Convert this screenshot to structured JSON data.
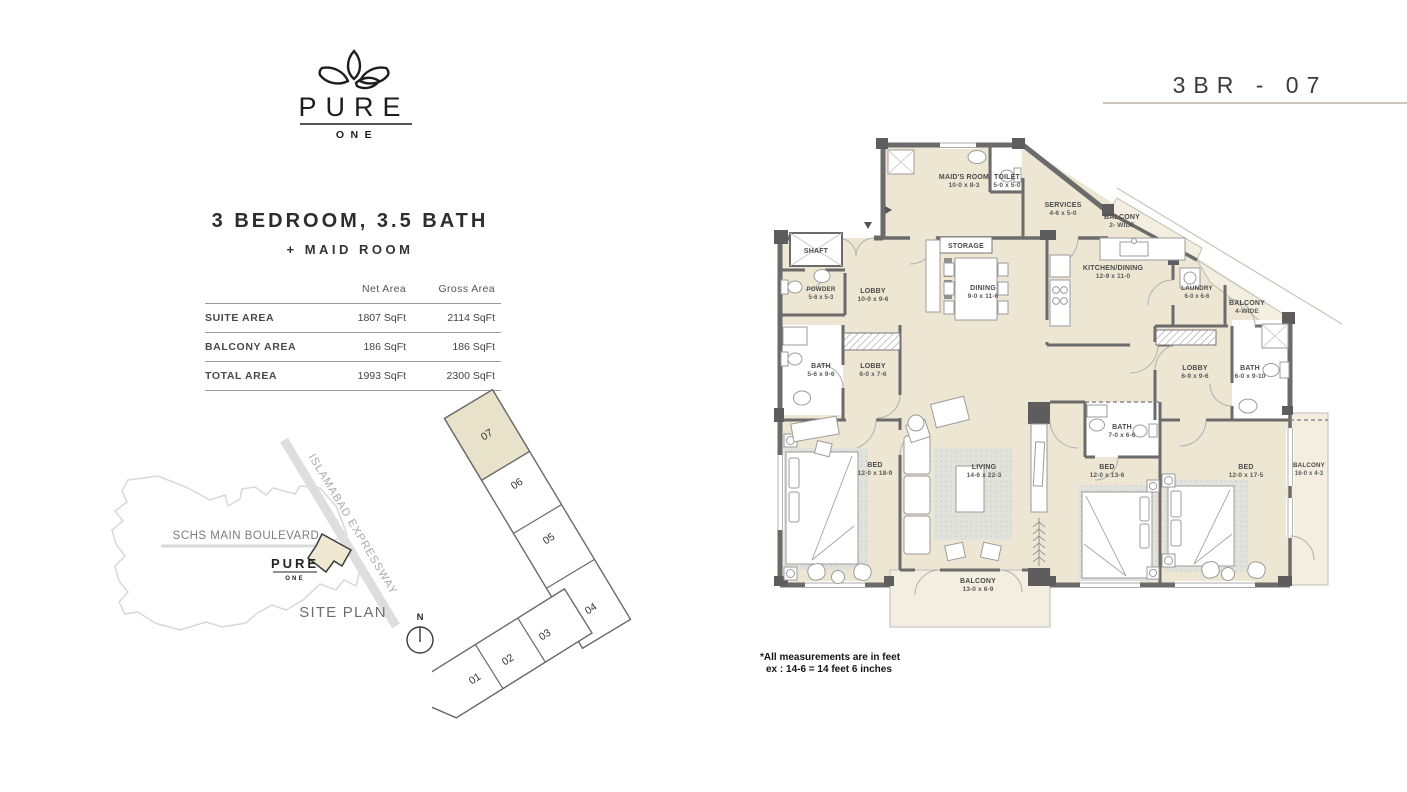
{
  "brand": {
    "name": "PURE",
    "sub": "ONE"
  },
  "header": {
    "unit_title": "3BR - 07"
  },
  "summary": {
    "title_line1": "3 BEDROOM, 3.5 BATH",
    "title_line2": "+ MAID ROOM"
  },
  "area_table": {
    "columns": [
      "Net Area",
      "Gross Area"
    ],
    "rows": [
      {
        "label": "SUITE AREA",
        "net": "1807 SqFt",
        "gross": "2114 SqFt"
      },
      {
        "label": "BALCONY AREA",
        "net": "186 SqFt",
        "gross": "186 SqFt"
      },
      {
        "label": "TOTAL AREA",
        "net": "1993 SqFt",
        "gross": "2300 SqFt"
      }
    ]
  },
  "site_plan": {
    "boulevard": "SCHS MAIN BOULEVARD",
    "expressway": "ISLAMABAD EXPRESSWAY",
    "caption": "SITE PLAN",
    "north": "N",
    "logo_top": "PURE",
    "logo_bottom": "ONE"
  },
  "key_plan": {
    "units": [
      "01",
      "02",
      "03",
      "04",
      "05",
      "06",
      "07"
    ],
    "highlighted": "07"
  },
  "floor_plan": {
    "rooms": [
      {
        "name": "MAID'S ROOM",
        "dims": "10-0 x 8-3"
      },
      {
        "name": "TOILET",
        "dims": "5-0 x 5-0"
      },
      {
        "name": "SERVICES",
        "dims": "4-6 x 5-0"
      },
      {
        "name": "BALCONY",
        "dims": "2- WIDE"
      },
      {
        "name": "SHAFT"
      },
      {
        "name": "STORAGE"
      },
      {
        "name": "DINING",
        "dims": "9-0 x 11-6"
      },
      {
        "name": "KITCHEN/DINING",
        "dims": "12-9 x 11-0"
      },
      {
        "name": "POWDER",
        "dims": "5-6 x 5-3"
      },
      {
        "name": "LOBBY",
        "dims": "10-0 x 9-6"
      },
      {
        "name": "LAUNDRY",
        "dims": "6-0 x 6-6"
      },
      {
        "name": "BALCONY",
        "dims": "4-WIDE"
      },
      {
        "name": "BATH",
        "dims": "5-6 x 9-6"
      },
      {
        "name": "LOBBY",
        "dims": "6-0 x 7-6"
      },
      {
        "name": "LOBBY",
        "dims": "6-9 x 9-6"
      },
      {
        "name": "BATH",
        "dims": "6-0 x 9-10"
      },
      {
        "name": "BATH",
        "dims": "7-0 x 6-6"
      },
      {
        "name": "BED",
        "dims": "12-0 x 18-9"
      },
      {
        "name": "LIVING",
        "dims": "14-6 x 22-3"
      },
      {
        "name": "BED",
        "dims": "12-0 x 13-6"
      },
      {
        "name": "BED",
        "dims": "12-0 x 17-5"
      },
      {
        "name": "BALCONY",
        "dims": "16-0 x 4-3"
      },
      {
        "name": "BALCONY",
        "dims": "13-0 x 6-9"
      }
    ],
    "note_line1": "*All measurements are in feet",
    "note_line2": "ex : 14-6 = 14 feet 6 inches"
  },
  "palette": {
    "floor_beige": "#ece6d3",
    "balcony_beige": "#f3eee0",
    "wall_gray": "#6b6b6b",
    "underline_tan": "#cfc7b9"
  }
}
